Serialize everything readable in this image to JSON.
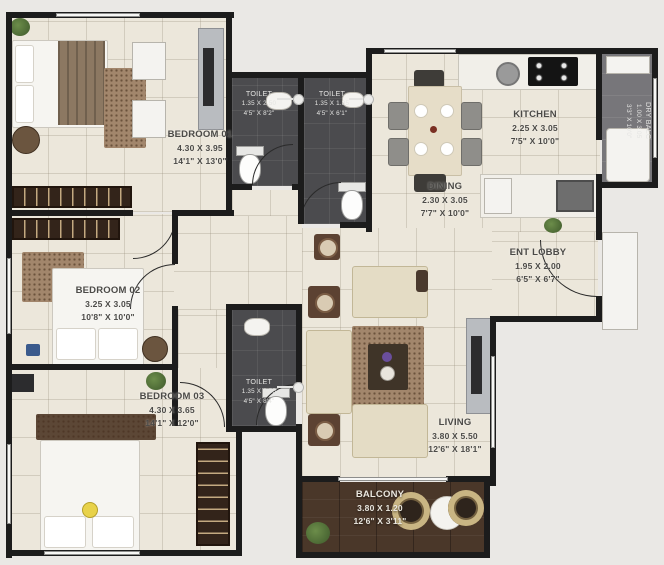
{
  "rooms": [
    {
      "id": "bedroom-01",
      "name": "BEDROOM 01",
      "size_m": "4.30 X 3.95",
      "size_ft": "14'1\" X 13'0\""
    },
    {
      "id": "toilet-1",
      "name": "TOILET",
      "size_m": "1.35 X 2.50",
      "size_ft": "4'5\" X 8'2\""
    },
    {
      "id": "toilet-2",
      "name": "TOILET",
      "size_m": "1.35 X 1.85",
      "size_ft": "4'5\" X 6'1\""
    },
    {
      "id": "kitchen",
      "name": "KITCHEN",
      "size_m": "2.25 X 3.05",
      "size_ft": "7'5\" X 10'0\""
    },
    {
      "id": "dry-balc",
      "name": "DRY BALC",
      "size_m": "1.00 X 3.05",
      "size_ft": "3'3\" X 10'0\""
    },
    {
      "id": "dining",
      "name": "DINING",
      "size_m": "2.30 X 3.05",
      "size_ft": "7'7\" X 10'0\""
    },
    {
      "id": "ent-lobby",
      "name": "ENT LOBBY",
      "size_m": "1.95 X 2.00",
      "size_ft": "6'5\" X 6'7\""
    },
    {
      "id": "bedroom-02",
      "name": "BEDROOM 02",
      "size_m": "3.25 X 3.05",
      "size_ft": "10'8\" X 10'0\""
    },
    {
      "id": "toilet-3",
      "name": "TOILET",
      "size_m": "1.35 X 2.55",
      "size_ft": "4'5\" X 8'4\""
    },
    {
      "id": "bedroom-03",
      "name": "BEDROOM 03",
      "size_m": "4.30 X 3.65",
      "size_ft": "14'1\" X 12'0\""
    },
    {
      "id": "living",
      "name": "LIVING",
      "size_m": "3.80 X 5.50",
      "size_ft": "12'6\" X 18'1\""
    },
    {
      "id": "balcony",
      "name": "BALCONY",
      "size_m": "3.80 X 1.20",
      "size_ft": "12'6\" X 3'11\""
    }
  ],
  "palette": {
    "wall": "#1c1c1c",
    "floor_tile": "#ece7db",
    "toilet_floor": "#4b4b4e",
    "dry_balc_floor": "#77767a",
    "balcony_wood": "#4a3729",
    "sofa_beige": "#e4dcc5",
    "wardrobe_brown": "#33241a",
    "rug_brown": "#a2866c",
    "plant_green": "#4e6b3a",
    "vase_purple": "#6a4e9c",
    "lamp_yellow": "#e8d24a"
  }
}
